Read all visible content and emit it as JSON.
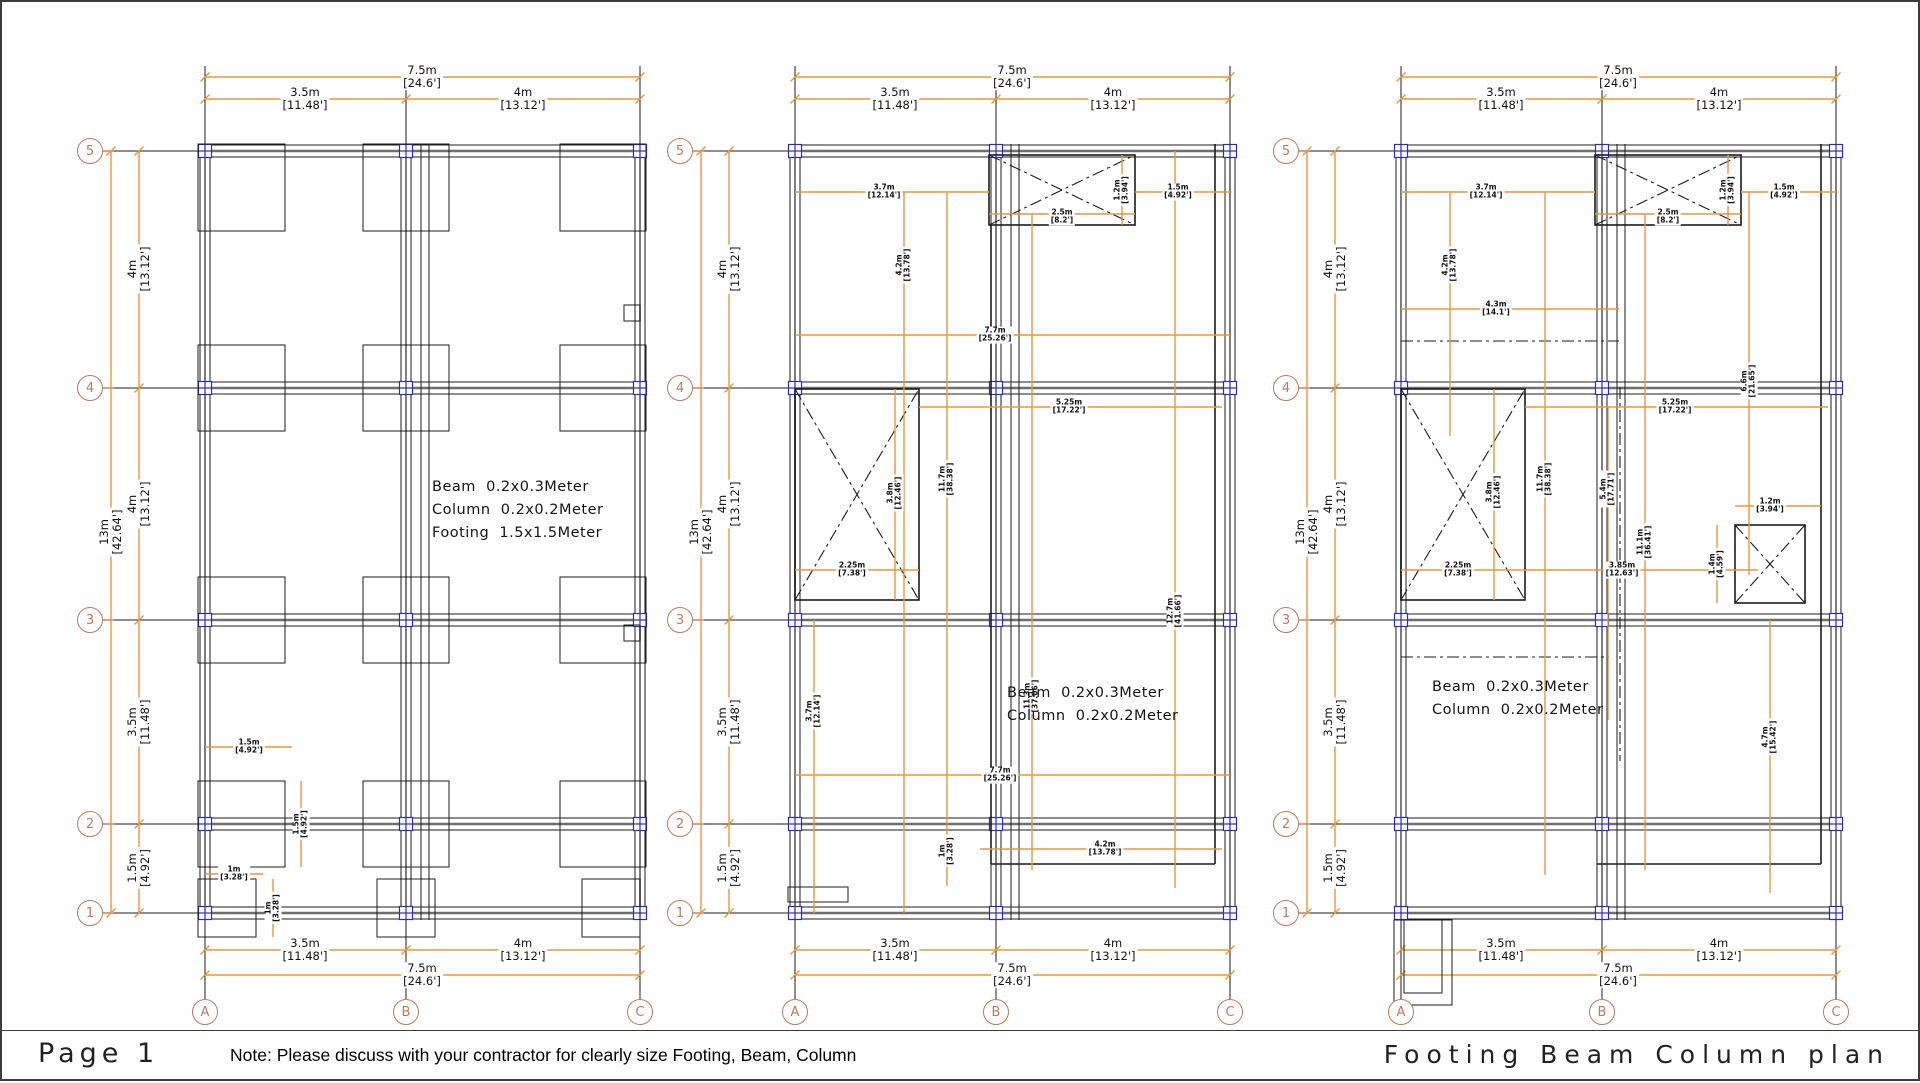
{
  "footer": {
    "page_label": "Page 1",
    "note": "Note: Please discuss with your contractor for clearly size Footing, Beam, Column",
    "title": "Footing Beam Column plan"
  },
  "grid": {
    "rows": [
      "5",
      "4",
      "3",
      "2",
      "1"
    ],
    "cols": [
      "A",
      "B",
      "C"
    ]
  },
  "outer_dims": {
    "top_total": {
      "m": "7.5m",
      "ft": "[24.6']"
    },
    "span35": {
      "m": "3.5m",
      "ft": "[11.48']"
    },
    "span4": {
      "m": "4m",
      "ft": "[13.12']"
    },
    "left_total": {
      "m": "13m",
      "ft": "[42.64']"
    },
    "span15": {
      "m": "1.5m",
      "ft": "[4.92']"
    }
  },
  "plans": [
    {
      "name": "footing plan",
      "notes": [
        "Beam  0.2x0.3Meter",
        "Column  0.2x0.2Meter",
        "Footing  1.5x1.5Meter"
      ],
      "dims": [
        {
          "m": "1.5m",
          "ft": "[4.92']"
        },
        {
          "m": "1.5m",
          "ft": "[4.92']"
        },
        {
          "m": "1m",
          "ft": "[3.28']"
        },
        {
          "m": "1m",
          "ft": "[3.28']"
        }
      ]
    },
    {
      "name": "beam plan",
      "notes": [
        "Beam  0.2x0.3Meter",
        "Column  0.2x0.2Meter"
      ],
      "dims": [
        {
          "m": "3.7m",
          "ft": "[12.14']"
        },
        {
          "m": "1.2m",
          "ft": "[3.94']"
        },
        {
          "m": "1.5m",
          "ft": "[4.92']"
        },
        {
          "m": "2.5m",
          "ft": "[8.2']"
        },
        {
          "m": "4.2m",
          "ft": "[13.78']"
        },
        {
          "m": "7.7m",
          "ft": "[25.26']"
        },
        {
          "m": "5.25m",
          "ft": "[17.22']"
        },
        {
          "m": "3.8m",
          "ft": "[12.46']"
        },
        {
          "m": "11.7m",
          "ft": "[38.38']"
        },
        {
          "m": "2.25m",
          "ft": "[7.38']"
        },
        {
          "m": "11.3m",
          "ft": "[37.06']"
        },
        {
          "m": "12.7m",
          "ft": "[41.66']"
        },
        {
          "m": "3.7m",
          "ft": "[12.14']"
        },
        {
          "m": "7.7m",
          "ft": "[25.26']"
        },
        {
          "m": "1m",
          "ft": "[3.28']"
        },
        {
          "m": "4.2m",
          "ft": "[13.78']"
        }
      ]
    },
    {
      "name": "beam plan",
      "notes": [
        "Beam  0.2x0.3Meter",
        "Column  0.2x0.2Meter"
      ],
      "dims": [
        {
          "m": "3.7m",
          "ft": "[12.14']"
        },
        {
          "m": "4.2m",
          "ft": "[13.78']"
        },
        {
          "m": "4.3m",
          "ft": "[14.1']"
        },
        {
          "m": "1.2m",
          "ft": "[3.94']"
        },
        {
          "m": "2.5m",
          "ft": "[8.2']"
        },
        {
          "m": "1.5m",
          "ft": "[4.92']"
        },
        {
          "m": "6.6m",
          "ft": "[21.65']"
        },
        {
          "m": "5.25m",
          "ft": "[17.22']"
        },
        {
          "m": "3.8m",
          "ft": "[12.46']"
        },
        {
          "m": "11.7m",
          "ft": "[38.38']"
        },
        {
          "m": "5.4m",
          "ft": "[17.71']"
        },
        {
          "m": "11.1m",
          "ft": "[36.41']"
        },
        {
          "m": "2.25m",
          "ft": "[7.38']"
        },
        {
          "m": "3.85m",
          "ft": "[12.63']"
        },
        {
          "m": "1.4m",
          "ft": "[4.59']"
        },
        {
          "m": "1.2m",
          "ft": "[3.94']"
        },
        {
          "m": "4.7m",
          "ft": "[15.42']"
        }
      ]
    }
  ],
  "colors": {
    "dimension_line": "#E8973B",
    "grid_bubble": "#C3795B",
    "column_marker": "#2B2BC4",
    "structure_line": "#1c1c1c",
    "grid_line": "#6f6f6f"
  }
}
